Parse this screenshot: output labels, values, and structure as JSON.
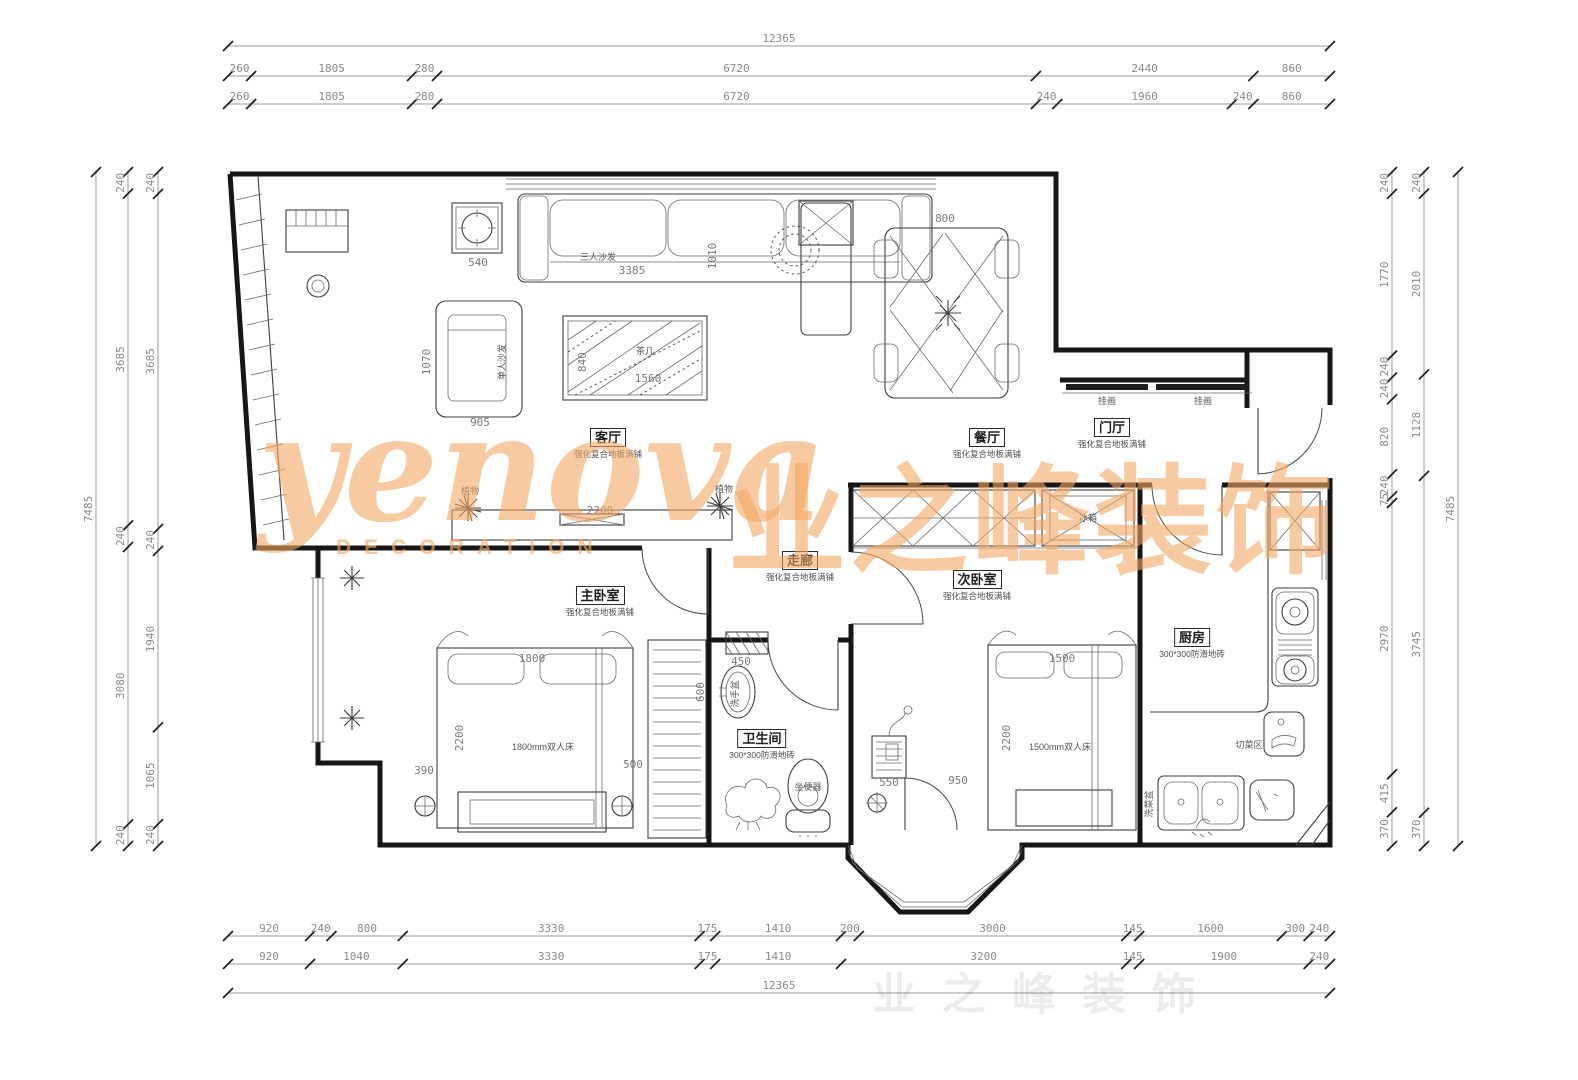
{
  "watermark": {
    "brand": "yenova",
    "tagline": "DECORATION",
    "cn": "业之峰装饰"
  },
  "dims": {
    "top_total": [
      "12365"
    ],
    "top_row2": [
      "260",
      "1805",
      "280",
      "6720",
      "2440",
      "860"
    ],
    "top_row3": [
      "260",
      "1805",
      "280",
      "6720",
      "240",
      "1960",
      "240",
      "860"
    ],
    "bottom_row1": [
      "920",
      "240",
      "800",
      "3330",
      "175",
      "1410",
      "200",
      "3000",
      "145",
      "1600",
      "300",
      "240"
    ],
    "bottom_row2": [
      "920",
      "1040",
      "3330",
      "175",
      "1410",
      "3200",
      "145",
      "1900",
      "240"
    ],
    "bottom_total": [
      "12365"
    ],
    "left_total": [
      "7485"
    ],
    "left_col2": [
      "240",
      "3685",
      "240",
      "3080",
      "240"
    ],
    "left_col3": [
      "240",
      "3685",
      "240",
      "1940",
      "1065",
      "240"
    ],
    "right_total": [
      "7485"
    ],
    "right_col2": [
      "240",
      "2010",
      "1128",
      "3745",
      "370"
    ],
    "right_col3": [
      "240",
      "1770",
      "240",
      "240",
      "820",
      "240",
      "75",
      "2970",
      "415",
      "370"
    ]
  },
  "rooms": {
    "living": {
      "name": "客厅",
      "floor": "强化复合地板满铺"
    },
    "dining": {
      "name": "餐厅",
      "floor": "强化复合地板满铺"
    },
    "entry": {
      "name": "门厅",
      "floor": "强化复合地板满铺"
    },
    "corridor": {
      "name": "走廊",
      "floor": "强化复合地板满铺"
    },
    "master": {
      "name": "主卧室",
      "floor": "强化复合地板满铺"
    },
    "second": {
      "name": "次卧室",
      "floor": "强化复合地板满铺"
    },
    "bath": {
      "name": "卫生间",
      "floor": "300*300防滑地砖"
    },
    "kitchen": {
      "name": "厨房",
      "floor": "300*300防滑地砖"
    }
  },
  "labels": {
    "sofa3": "三人沙发",
    "sofa1": "单人沙发",
    "tea_table": "茶几",
    "plant1": "植物",
    "plant2": "植物",
    "hang_pic1": "挂画",
    "hang_pic2": "挂画",
    "master_bed": "1800mm双人床",
    "second_bed": "1500mm双人床",
    "basin": "洗手盆",
    "toilet": "坐便器",
    "cutting": "切菜区",
    "sink": "洗菜盆",
    "fridge": "冰箱"
  },
  "inner_dims": {
    "sofa_len": "3385",
    "sofa_depth": "1010",
    "side_table": "540",
    "sofa1_w": "905",
    "sofa1_d": "1070",
    "tea_len": "1560",
    "tea_w": "840",
    "tv_wall": "2200",
    "dining_w": "800",
    "mbed_w": "1800",
    "mbed_l": "2200",
    "m_left": "390",
    "m_right": "500",
    "ward_d": "450",
    "ward_w": "600",
    "sbed_w": "1500",
    "sbed_l": "2200",
    "s_a": "550",
    "s_b": "950"
  }
}
